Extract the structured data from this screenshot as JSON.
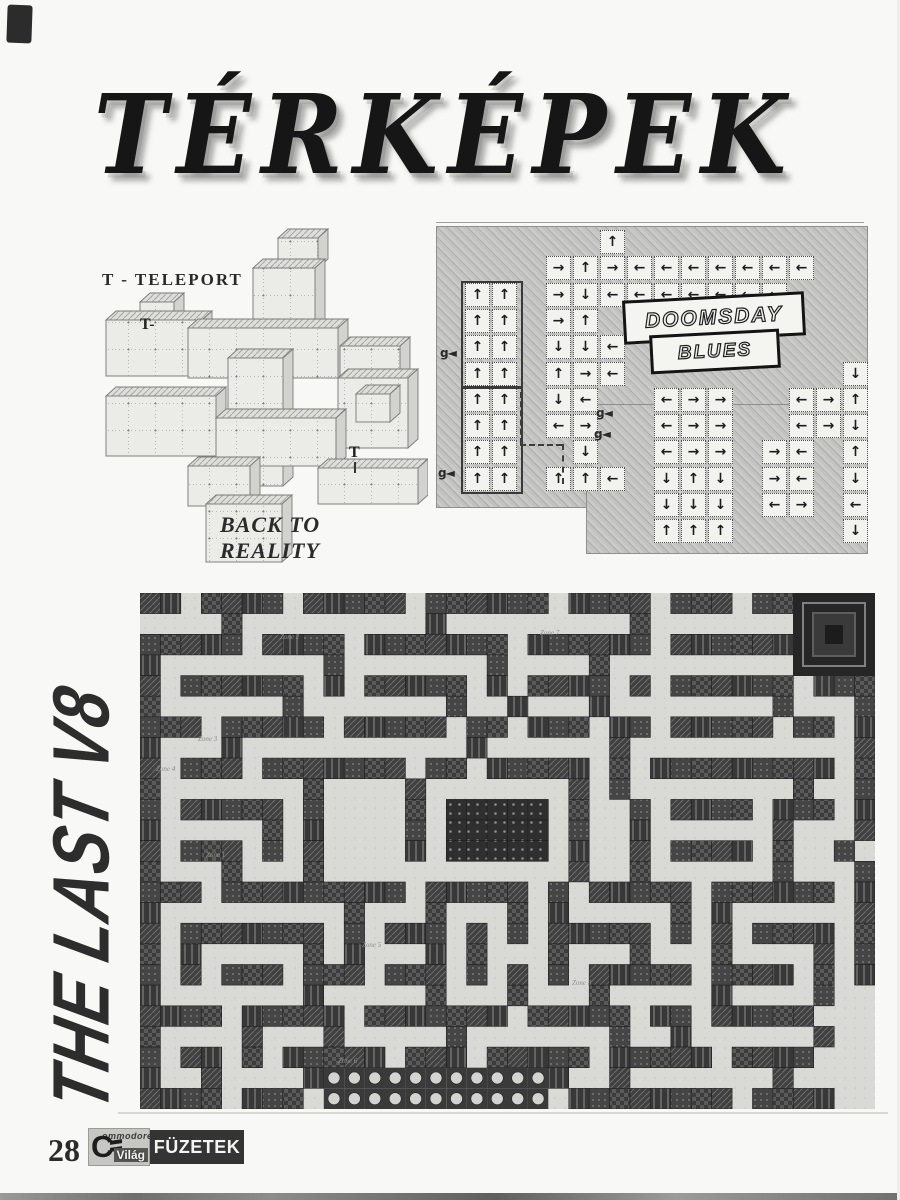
{
  "page": {
    "title": "TÉRKÉPEK"
  },
  "iso_map": {
    "legend": "T - TELEPORT",
    "teleport_a": "T-",
    "teleport_b": "T",
    "title_line1": "BACK TO",
    "title_line2": "REALITY"
  },
  "doomsday": {
    "logo_line1": "DOOMSDAY",
    "logo_line2": "BLUES",
    "arrow_glyphs": {
      "U": "↑",
      "D": "↓",
      "L": "←",
      "R": "→"
    },
    "grid": [
      "......U.........",
      "....RURLLLLLLL..",
      ".UU.RDLLLLLLL...",
      ".UU.RU.L........",
      ".UU.DDL.........",
      ".UU.URL........D",
      ".UU.DL..LRR..LRU",
      ".UU.LR..LRR..LRD",
      ".UU..D..LRR.RL.U",
      ".UU.UUL.DUD.RL.D",
      "........DDD.LR.L",
      "........UUU....D"
    ],
    "g_labels": [
      {
        "x": 4,
        "y": 124,
        "text": "g◄"
      },
      {
        "x": 2,
        "y": 244,
        "text": "g◄"
      },
      {
        "x": 160,
        "y": 184,
        "text": "g◄"
      },
      {
        "x": 158,
        "y": 205,
        "text": "g◄"
      }
    ]
  },
  "last_v8": {
    "side_title": "THE LAST V8",
    "grid": [
      "##.####.#####.######.####.###.##XXXX",
      "....#.........#.........#.......XXXX",
      "#####.####.#######.######.######XXXX",
      "#........#.......#....#.........XXXX",
      "#.######.#.#####.#.####.#.######.###",
      "#......#.......#..#...#........#...#",
      "###.#####.#####.##.###.##.#####.##.#",
      "#...#...........#......#...........#",
      "#.###.#######.##.#####.#.#########.#",
      "#.......#....#.......#.#........#..#",
      "#.#####.#....#.BBBBB.#..#.####.###.#",
      "#.....#.#....#.BBBBB.#..#......#...#",
      "#.###.#.#....#.BBBBB.#..#.####.#..#.",
      "#...#...#............#..#......#...#",
      "###.#########.#####.#.#####.######.#",
      "#.........#...#...#.#.....#.#......#",
      "#.#######.#.###.#.#.#####.#.#.####.#",
      "#.#.....#.#...#.#...#...#...#....#.#",
      "#.#.###.###.###.#.#.#.#####.####.#.#",
      "#.......#.....#...#...#.....#....#..",
      "####.#####.#######.#####.##.#####...",
      "#....#...#.....#.......#..#......#..",
      "#.##.#.#####.###.#####.#####.####...",
      "#..#....#ooooooooooo#..#.......#....",
      "####.###.ooooooooooo.########.####.."
    ],
    "zone_labels": [
      {
        "x": 140,
        "y": 46,
        "text": "Zone 2"
      },
      {
        "x": 400,
        "y": 42,
        "text": "Zone 7"
      },
      {
        "x": 58,
        "y": 148,
        "text": "Zone 3"
      },
      {
        "x": 16,
        "y": 178,
        "text": "Zone 4"
      },
      {
        "x": 66,
        "y": 264,
        "text": "Zone 1"
      },
      {
        "x": 222,
        "y": 354,
        "text": "Zone 5"
      },
      {
        "x": 432,
        "y": 392,
        "text": "Zone 8"
      },
      {
        "x": 198,
        "y": 470,
        "text": "Zone 6"
      }
    ]
  },
  "footer": {
    "page_number": "28",
    "brand_c": "C",
    "brand_top": "ommodore",
    "brand_bottom": "Világ",
    "booklet": "FÜZETEK"
  }
}
